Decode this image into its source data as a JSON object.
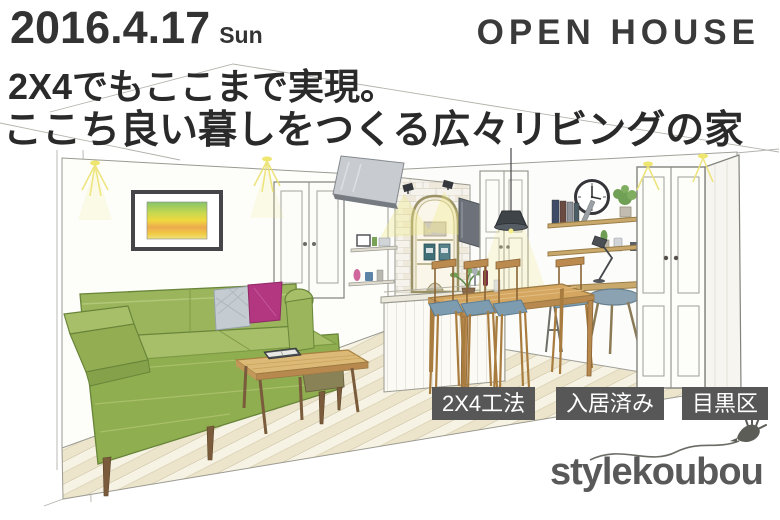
{
  "header": {
    "date": "2016.4.17",
    "day": "Sun",
    "title": "OPEN HOUSE"
  },
  "headline": {
    "line1": "2X4でもここまで実現。",
    "line2": "ここち良い暮しをつくる広々リビングの家"
  },
  "tags": [
    {
      "label": "2X4工法"
    },
    {
      "label": "入居済み"
    },
    {
      "label": "目黒区"
    }
  ],
  "brand": {
    "logo": "stylekoubou",
    "bird_icon": "bird-doodle-icon"
  },
  "illustration": {
    "type": "hand-drawn interior perspective sketch",
    "scene": "spacious living-dining room: green L-shaped sofa with magenta and gray cushions, wooden coffee table with open book, framed striped artwork, white double doors, wall-mounted screen, white-brick kitchen niche with spotlights, slatted counter with plant, pendant lamp, dining table with blue-seat chairs, wall clock, book shelves, desk with laptop and lamp, stool, tall white cabinet, diagonal striped wood floor, yellow ceiling light glows",
    "palette": {
      "sofa_green": "#8fae4f",
      "cushion_magenta": "#b23680",
      "cushion_gray": "#c4ccd2",
      "wood": "#c9a96b",
      "floor": "#f4efdc",
      "seat_blue": "#7e9cb0",
      "lamp_dark": "#3f4449",
      "glow_yellow": "#eee66e",
      "outline": "#8a8a85"
    }
  },
  "colors": {
    "text_dark": "#2f2f2f",
    "tag_bg": "#575757",
    "tag_text": "#ffffff",
    "logo_gray": "#595959",
    "background": "#ffffff"
  }
}
